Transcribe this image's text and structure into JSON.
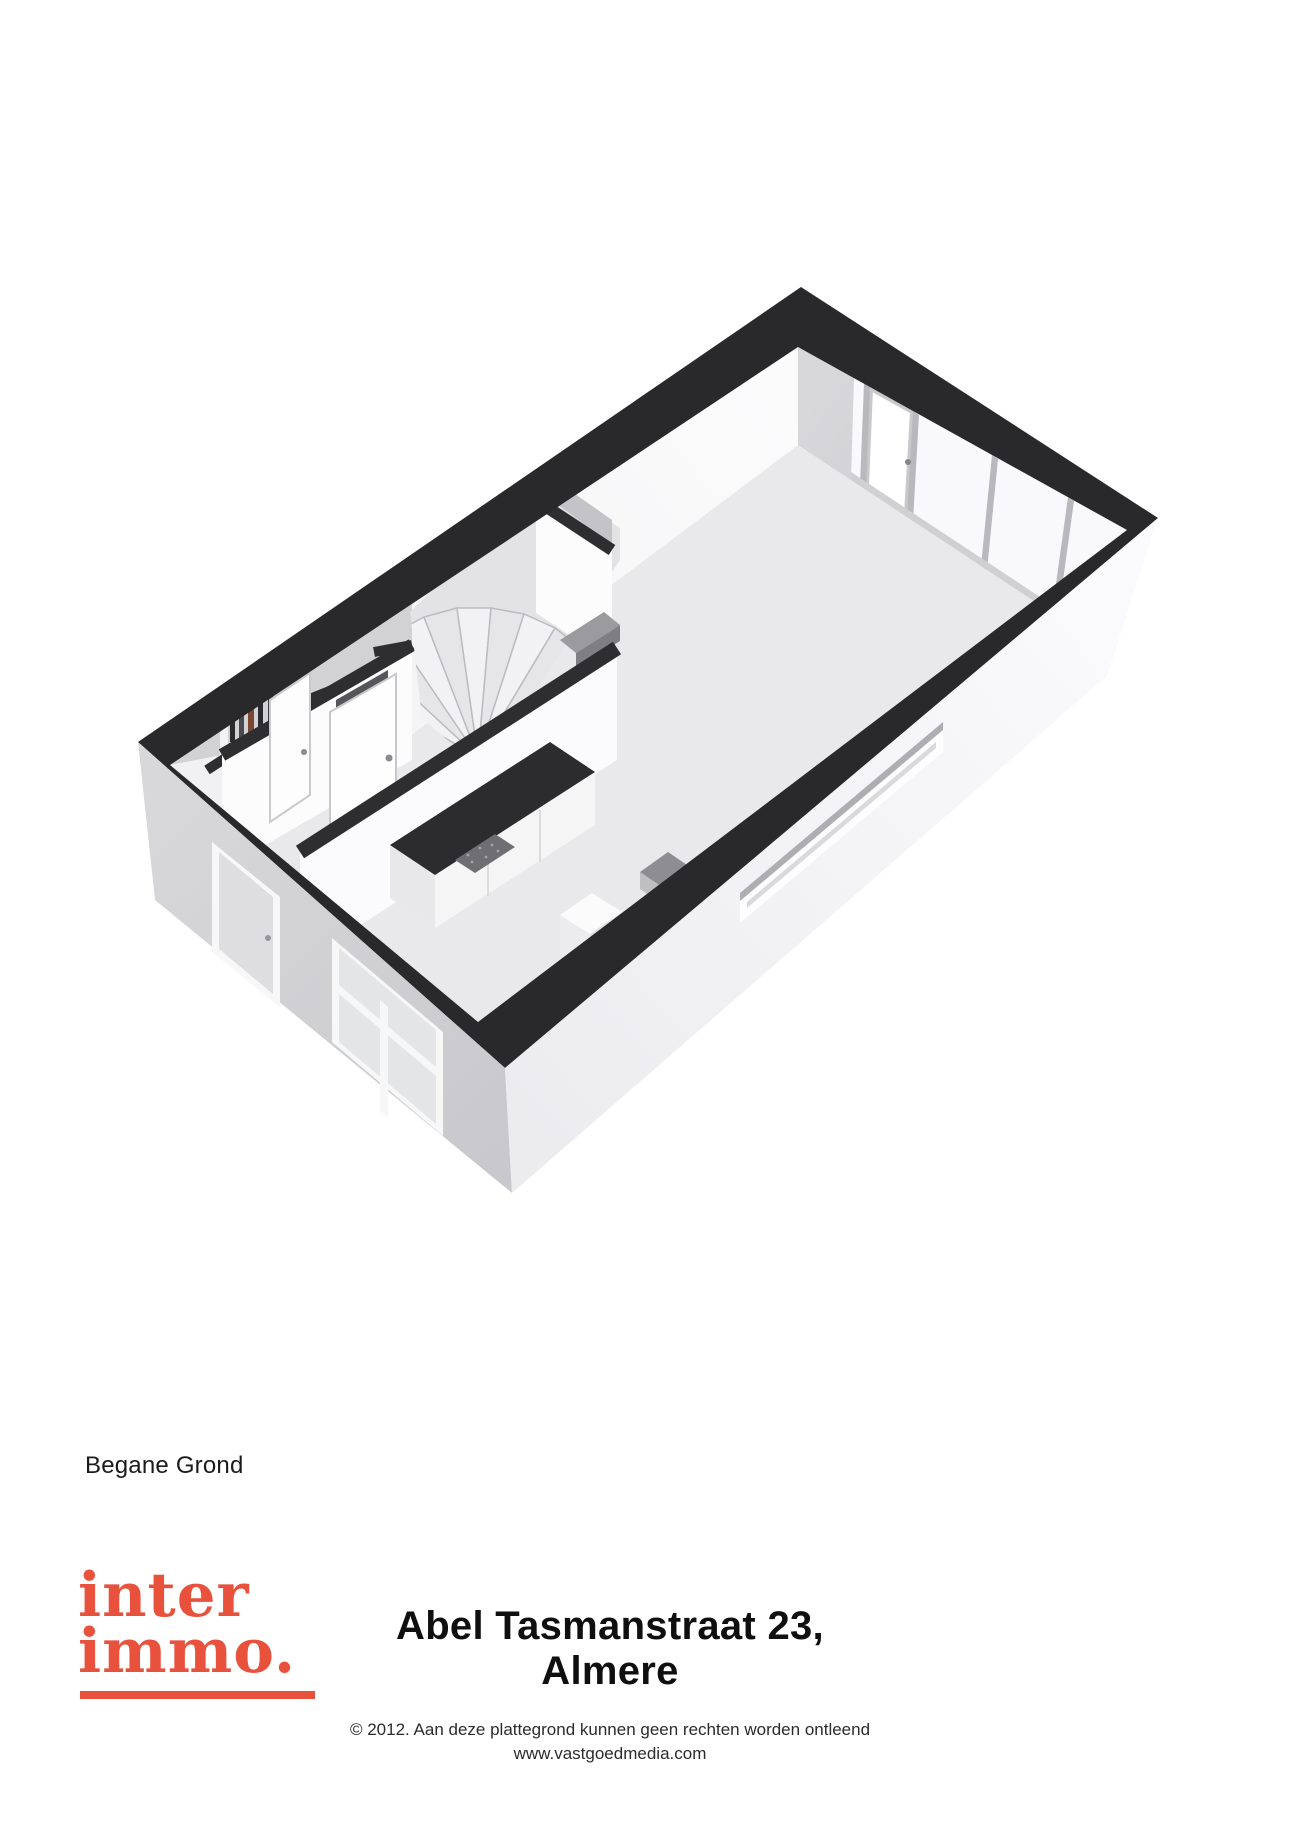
{
  "floor_label": "Begane Grond",
  "logo": {
    "line1": "inter",
    "line2": "immo.",
    "brand_color": "#e8513c"
  },
  "footer": {
    "title": "Abel Tasmanstraat 23, Almere",
    "copyright_line": "© 2012. Aan deze plattegrond kunnen geen rechten worden ontleend",
    "website": "www.vastgoedmedia.com"
  },
  "floorplan": {
    "type": "3d-isometric-floorplan",
    "floor_name": "Begane Grond",
    "colors": {
      "cut_wall_band": "#29292b",
      "floor": "#e9e9eb",
      "interior_wall_light": "#f6f6f8",
      "interior_wall_shadow": "#cfcfd3",
      "exterior_wall_front": "#d4d4d7",
      "exterior_wall_right": "#f2f2f4",
      "counter_top": "#2c2c2e",
      "meter_pipe_accent": "#7a4632"
    },
    "features": [
      "living-room-with-sliding-glass-doors",
      "winder-staircase",
      "hallway-with-front-door",
      "toilet-with-door-and-transom-slit",
      "meter-cupboard-with-pipes",
      "kitchen-counter-with-cooktop",
      "slit-window-right-facade",
      "window-and-door-front-facade"
    ]
  }
}
